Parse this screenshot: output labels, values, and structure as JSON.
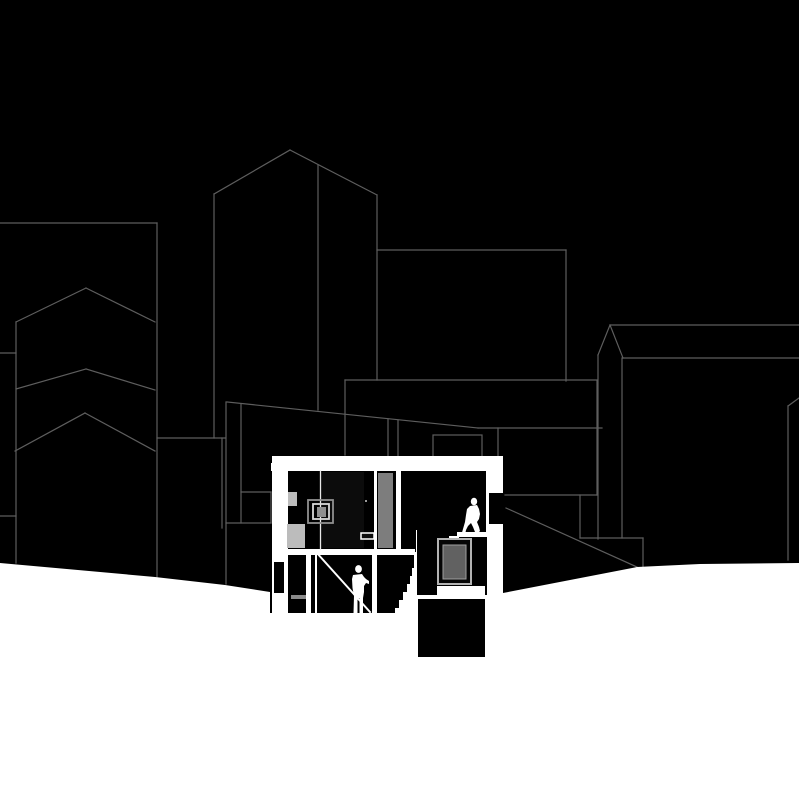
{
  "canvas": {
    "width": 799,
    "height": 800,
    "background": "#000000"
  },
  "palette": {
    "background": "#000000",
    "outline_gray": "#5e5e5e",
    "cut_white": "#ffffff",
    "light_gray_block": "#bcbcbc",
    "wardrobe_gray": "#7d7d7d",
    "pane_gray": "#616161",
    "frame_gray": "#b3b3b3",
    "door_panel_dark": "#0c0c0c",
    "step_gray": "#8a8a8a"
  },
  "layers": [
    {
      "name": "left-building-top-edge",
      "type": "line",
      "x1": 0,
      "y1": 223,
      "x2": 157,
      "y2": 223,
      "stroke": "#5e5e5e",
      "sw": 1.2
    },
    {
      "name": "left-building-right-edge",
      "type": "line",
      "x1": 157,
      "y1": 223,
      "x2": 157,
      "y2": 577,
      "stroke": "#5e5e5e",
      "sw": 1.2
    },
    {
      "name": "left-building-lower-edge",
      "type": "line",
      "x1": 157,
      "y1": 438,
      "x2": 225,
      "y2": 438,
      "stroke": "#5e5e5e",
      "sw": 1.2
    },
    {
      "name": "left-building-inner-vertical",
      "type": "line",
      "x1": 222,
      "y1": 438,
      "x2": 222,
      "y2": 528,
      "stroke": "#5e5e5e",
      "sw": 1.2
    },
    {
      "name": "gable-chevron-1-left",
      "type": "line",
      "x1": 16,
      "y1": 322,
      "x2": 86,
      "y2": 288,
      "stroke": "#5e5e5e",
      "sw": 1.2
    },
    {
      "name": "gable-chevron-1-right",
      "type": "line",
      "x1": 86,
      "y1": 288,
      "x2": 155,
      "y2": 322,
      "stroke": "#5e5e5e",
      "sw": 1.2
    },
    {
      "name": "gable-chevron-2-left",
      "type": "line",
      "x1": 16,
      "y1": 389,
      "x2": 86,
      "y2": 369,
      "stroke": "#5e5e5e",
      "sw": 1.2
    },
    {
      "name": "gable-chevron-2-right",
      "type": "line",
      "x1": 86,
      "y1": 369,
      "x2": 155,
      "y2": 390,
      "stroke": "#5e5e5e",
      "sw": 1.2
    },
    {
      "name": "gable-chevron-3-left",
      "type": "line",
      "x1": 15,
      "y1": 451,
      "x2": 85,
      "y2": 413,
      "stroke": "#5e5e5e",
      "sw": 1.2
    },
    {
      "name": "gable-chevron-3-right",
      "type": "line",
      "x1": 85,
      "y1": 413,
      "x2": 155,
      "y2": 451,
      "stroke": "#5e5e5e",
      "sw": 1.2
    },
    {
      "name": "gable-building-left-edge",
      "type": "line",
      "x1": 16,
      "y1": 322,
      "x2": 16,
      "y2": 563,
      "stroke": "#5e5e5e",
      "sw": 1.2
    },
    {
      "name": "left-edge-tick-upper",
      "type": "line",
      "x1": 0,
      "y1": 353,
      "x2": 16,
      "y2": 353,
      "stroke": "#5e5e5e",
      "sw": 1.2
    },
    {
      "name": "left-edge-tick-lower",
      "type": "line",
      "x1": 0,
      "y1": 516,
      "x2": 16,
      "y2": 516,
      "stroke": "#5e5e5e",
      "sw": 1.2
    },
    {
      "name": "tower-roof-left-slope",
      "type": "line",
      "x1": 214,
      "y1": 194,
      "x2": 290,
      "y2": 150,
      "stroke": "#5e5e5e",
      "sw": 1.2
    },
    {
      "name": "tower-roof-right-slope",
      "type": "line",
      "x1": 290,
      "y1": 150,
      "x2": 377,
      "y2": 195,
      "stroke": "#5e5e5e",
      "sw": 1.2
    },
    {
      "name": "tower-left-edge",
      "type": "line",
      "x1": 214,
      "y1": 194,
      "x2": 214,
      "y2": 438,
      "stroke": "#5e5e5e",
      "sw": 1.2
    },
    {
      "name": "tower-right-edge",
      "type": "line",
      "x1": 377,
      "y1": 195,
      "x2": 377,
      "y2": 380,
      "stroke": "#5e5e5e",
      "sw": 1.2
    },
    {
      "name": "tower-inner-vertical",
      "type": "line",
      "x1": 318,
      "y1": 165,
      "x2": 318,
      "y2": 410,
      "stroke": "#5e5e5e",
      "sw": 1.2
    },
    {
      "name": "midground-vertical-226",
      "type": "line",
      "x1": 226,
      "y1": 402,
      "x2": 226,
      "y2": 584,
      "stroke": "#5e5e5e",
      "sw": 1.2
    },
    {
      "name": "long-roof-slope",
      "type": "line",
      "x1": 227,
      "y1": 402,
      "x2": 478,
      "y2": 428,
      "stroke": "#5e5e5e",
      "sw": 1.2
    },
    {
      "name": "long-roof-flat",
      "type": "line",
      "x1": 478,
      "y1": 428,
      "x2": 602,
      "y2": 428,
      "stroke": "#5e5e5e",
      "sw": 1.2
    },
    {
      "name": "midground-vertical-241",
      "type": "line",
      "x1": 241,
      "y1": 404,
      "x2": 241,
      "y2": 523,
      "stroke": "#5e5e5e",
      "sw": 1.2
    },
    {
      "name": "midground-horizontal-492",
      "type": "line",
      "x1": 241,
      "y1": 492,
      "x2": 271,
      "y2": 492,
      "stroke": "#5e5e5e",
      "sw": 1.2
    },
    {
      "name": "midground-vertical-271",
      "type": "line",
      "x1": 271,
      "y1": 492,
      "x2": 271,
      "y2": 523,
      "stroke": "#5e5e5e",
      "sw": 1.2
    },
    {
      "name": "midground-horizontal-523",
      "type": "line",
      "x1": 226,
      "y1": 523,
      "x2": 271,
      "y2": 523,
      "stroke": "#5e5e5e",
      "sw": 1.2
    },
    {
      "name": "mid-block-top-edge",
      "type": "line",
      "x1": 377,
      "y1": 250,
      "x2": 566,
      "y2": 250,
      "stroke": "#5e5e5e",
      "sw": 1.2
    },
    {
      "name": "mid-block-right-edge",
      "type": "line",
      "x1": 566,
      "y1": 250,
      "x2": 566,
      "y2": 381,
      "stroke": "#5e5e5e",
      "sw": 1.2
    },
    {
      "name": "mid-block-bottom-edge",
      "type": "line",
      "x1": 345,
      "y1": 380,
      "x2": 597,
      "y2": 380,
      "stroke": "#5e5e5e",
      "sw": 1.2
    },
    {
      "name": "mid-block-left-drop",
      "type": "line",
      "x1": 345,
      "y1": 380,
      "x2": 345,
      "y2": 455,
      "stroke": "#5e5e5e",
      "sw": 1.2
    },
    {
      "name": "mid-block-right-drop",
      "type": "line",
      "x1": 597,
      "y1": 381,
      "x2": 597,
      "y2": 495,
      "stroke": "#5e5e5e",
      "sw": 1.2
    },
    {
      "name": "rear-terrace-edge",
      "type": "line",
      "x1": 505,
      "y1": 495,
      "x2": 597,
      "y2": 495,
      "stroke": "#5e5e5e",
      "sw": 1.2
    },
    {
      "name": "rear-step-vertical-580",
      "type": "line",
      "x1": 580,
      "y1": 495,
      "x2": 580,
      "y2": 538,
      "stroke": "#5e5e5e",
      "sw": 1.2
    },
    {
      "name": "rear-step-horizontal-538",
      "type": "line",
      "x1": 580,
      "y1": 538,
      "x2": 643,
      "y2": 538,
      "stroke": "#5e5e5e",
      "sw": 1.2
    },
    {
      "name": "rear-step-vertical-643",
      "type": "line",
      "x1": 643,
      "y1": 538,
      "x2": 643,
      "y2": 567,
      "stroke": "#5e5e5e",
      "sw": 1.2
    },
    {
      "name": "rear-ramp-diagonal",
      "type": "line",
      "x1": 506,
      "y1": 508,
      "x2": 637,
      "y2": 567,
      "stroke": "#5e5e5e",
      "sw": 1.2
    },
    {
      "name": "roof-drop-vertical-498",
      "type": "line",
      "x1": 498,
      "y1": 428,
      "x2": 498,
      "y2": 456,
      "stroke": "#5e5e5e",
      "sw": 1.2
    },
    {
      "name": "roof-drop-vertical-388",
      "type": "line",
      "x1": 388,
      "y1": 419,
      "x2": 388,
      "y2": 456,
      "stroke": "#5e5e5e",
      "sw": 1.2
    },
    {
      "name": "roof-drop-vertical-398",
      "type": "line",
      "x1": 398,
      "y1": 420,
      "x2": 398,
      "y2": 456,
      "stroke": "#5e5e5e",
      "sw": 1.2
    },
    {
      "name": "chimney-outline",
      "type": "rect",
      "x": 433,
      "y": 435,
      "w": 49,
      "h": 23,
      "fill": "#000000",
      "stroke": "#5e5e5e",
      "sw": 1.2
    },
    {
      "name": "spire-left-slope",
      "type": "line",
      "x1": 598,
      "y1": 355,
      "x2": 610,
      "y2": 325,
      "stroke": "#5e5e5e",
      "sw": 1.2
    },
    {
      "name": "spire-right-slope",
      "type": "line",
      "x1": 610,
      "y1": 325,
      "x2": 623,
      "y2": 358,
      "stroke": "#5e5e5e",
      "sw": 1.2
    },
    {
      "name": "spire-left-edge",
      "type": "line",
      "x1": 598,
      "y1": 355,
      "x2": 598,
      "y2": 539,
      "stroke": "#5e5e5e",
      "sw": 1.2
    },
    {
      "name": "spire-right-edge",
      "type": "line",
      "x1": 622,
      "y1": 358,
      "x2": 622,
      "y2": 538,
      "stroke": "#5e5e5e",
      "sw": 1.2
    },
    {
      "name": "right-building-parapet",
      "type": "line",
      "x1": 610,
      "y1": 325,
      "x2": 799,
      "y2": 325,
      "stroke": "#5e5e5e",
      "sw": 1.2
    },
    {
      "name": "right-building-roofline",
      "type": "line",
      "x1": 623,
      "y1": 358,
      "x2": 799,
      "y2": 358,
      "stroke": "#5e5e5e",
      "sw": 1.2
    },
    {
      "name": "far-right-vertical",
      "type": "line",
      "x1": 788,
      "y1": 406,
      "x2": 788,
      "y2": 560,
      "stroke": "#5e5e5e",
      "sw": 1.2
    },
    {
      "name": "far-right-diagonal",
      "type": "line",
      "x1": 788,
      "y1": 406,
      "x2": 799,
      "y2": 398,
      "stroke": "#5e5e5e",
      "sw": 1.2
    },
    {
      "name": "ground-plane",
      "type": "polygon",
      "points": "0,563 155,577 225,585 270,592 270,613 414,613 414,595 489,595 489,593 503,593 637,567 700,564 799,563 799,800 0,800",
      "fill": "#ffffff"
    },
    {
      "name": "section-roof-band",
      "type": "rect",
      "x": 271,
      "y": 456,
      "w": 232,
      "h": 15,
      "fill": "#ffffff"
    },
    {
      "name": "section-roof-corner-notch",
      "type": "rect",
      "x": 271,
      "y": 456,
      "w": 12,
      "h": 7,
      "fill": "#000000"
    },
    {
      "name": "section-left-wall",
      "type": "rect",
      "x": 272,
      "y": 456,
      "w": 18,
      "h": 157,
      "fill": "#ffffff"
    },
    {
      "name": "left-wall-window-opening",
      "type": "rect",
      "x": 274,
      "y": 562,
      "w": 10,
      "h": 31,
      "fill": "#000000"
    },
    {
      "name": "section-right-wall",
      "type": "rect",
      "x": 486,
      "y": 456,
      "w": 17,
      "h": 139,
      "fill": "#ffffff"
    },
    {
      "name": "right-wall-window-opening",
      "type": "rect",
      "x": 489,
      "y": 493,
      "w": 14,
      "h": 31,
      "fill": "#000000"
    },
    {
      "name": "upper-rooms-interior",
      "type": "rect",
      "x": 288,
      "y": 471,
      "w": 198,
      "h": 78,
      "fill": "#000000"
    },
    {
      "name": "lower-room-interior",
      "type": "rect",
      "x": 288,
      "y": 549,
      "w": 129,
      "h": 64,
      "fill": "#000000"
    },
    {
      "name": "mid-floor-slab",
      "type": "rect",
      "x": 288,
      "y": 549,
      "w": 129,
      "h": 6,
      "fill": "#ffffff"
    },
    {
      "name": "window-room-interior",
      "type": "rect",
      "x": 415,
      "y": 537,
      "w": 72,
      "h": 58,
      "fill": "#000000"
    },
    {
      "name": "right-light-well",
      "type": "rect",
      "x": 487,
      "y": 537,
      "w": 16,
      "h": 58,
      "fill": "#ffffff"
    },
    {
      "name": "upper-right-floor-slab",
      "type": "rect",
      "x": 457,
      "y": 532,
      "w": 46,
      "h": 5,
      "fill": "#ffffff"
    },
    {
      "name": "entry-step-1",
      "type": "rect",
      "x": 449,
      "y": 536,
      "w": 10,
      "h": 5,
      "fill": "#ffffff"
    },
    {
      "name": "entry-step-2",
      "type": "rect",
      "x": 443,
      "y": 540,
      "w": 10,
      "h": 5,
      "fill": "#ffffff"
    },
    {
      "name": "entry-step-3",
      "type": "rect",
      "x": 437,
      "y": 544,
      "w": 10,
      "h": 5,
      "fill": "#ffffff"
    },
    {
      "name": "main-staircase",
      "type": "polygon",
      "points": "417,530 417,613 395,613 395,608 399,608 399,600 403,600 403,592 407,592 407,584 410,584 410,576 412,576 412,568 414,568 414,552 416,552 416,530",
      "fill": "#ffffff"
    },
    {
      "name": "basement-slit",
      "type": "rect",
      "x": 437,
      "y": 586,
      "w": 48,
      "h": 9,
      "fill": "#ffffff"
    },
    {
      "name": "basement-block",
      "type": "rect",
      "x": 418,
      "y": 599,
      "w": 67,
      "h": 58,
      "fill": "#000000"
    },
    {
      "name": "stair-room-stud-1",
      "type": "rect",
      "x": 306,
      "y": 555,
      "w": 5,
      "h": 58,
      "fill": "#ffffff"
    },
    {
      "name": "stair-room-stud-2",
      "type": "rect",
      "x": 315,
      "y": 555,
      "w": 2,
      "h": 58,
      "fill": "#ffffff"
    },
    {
      "name": "stair-room-stud-3",
      "type": "rect",
      "x": 372,
      "y": 555,
      "w": 5,
      "h": 58,
      "fill": "#ffffff"
    },
    {
      "name": "stair-room-step-gray",
      "type": "rect",
      "x": 291,
      "y": 595,
      "w": 15,
      "h": 4,
      "fill": "#8a8a8a"
    },
    {
      "name": "stair-stringer-diagonal",
      "type": "line",
      "x1": 316,
      "y1": 552,
      "x2": 370,
      "y2": 612,
      "stroke": "#ffffff",
      "sw": 2
    },
    {
      "name": "door-panel",
      "type": "rect",
      "x": 321,
      "y": 472,
      "w": 43,
      "h": 76,
      "fill": "#0c0c0c"
    },
    {
      "name": "room-divider-line",
      "type": "line",
      "x1": 320.5,
      "y1": 471,
      "x2": 320.5,
      "y2": 549,
      "stroke": "#e8e8e8",
      "sw": 1.3
    },
    {
      "name": "wall-block-upper",
      "type": "rect",
      "x": 288,
      "y": 492,
      "w": 9,
      "h": 14,
      "fill": "#bcbcbc"
    },
    {
      "name": "wall-block-lower",
      "type": "rect",
      "x": 287,
      "y": 524,
      "w": 18,
      "h": 24,
      "fill": "#bcbcbc"
    },
    {
      "name": "wall-art-square-outer",
      "type": "rect",
      "x": 308,
      "y": 500,
      "w": 25,
      "h": 23,
      "fill": "none",
      "stroke": "#909090",
      "sw": 1.8
    },
    {
      "name": "wall-art-square-mid",
      "type": "rect",
      "x": 313,
      "y": 504,
      "w": 16,
      "h": 15,
      "fill": "none",
      "stroke": "#d8d8d8",
      "sw": 1.8
    },
    {
      "name": "wall-art-square-center",
      "type": "rect",
      "x": 317,
      "y": 507,
      "w": 9,
      "h": 10,
      "fill": "#8f8f8f"
    },
    {
      "name": "door-handle-dot",
      "type": "rect",
      "x": 365,
      "y": 500,
      "w": 2,
      "h": 2,
      "fill": "#9a9a9a"
    },
    {
      "name": "shelf-outline",
      "type": "rect",
      "x": 361,
      "y": 533,
      "w": 13,
      "h": 6,
      "fill": "#0c0c0c",
      "stroke": "#ffffff",
      "sw": 1.5
    },
    {
      "name": "wardrobe-gap-left",
      "type": "rect",
      "x": 374,
      "y": 471,
      "w": 3,
      "h": 78,
      "fill": "#ffffff"
    },
    {
      "name": "wardrobe-panel",
      "type": "rect",
      "x": 378,
      "y": 473,
      "w": 15,
      "h": 75,
      "fill": "#7d7d7d"
    },
    {
      "name": "wardrobe-gap-right",
      "type": "rect",
      "x": 396,
      "y": 471,
      "w": 5,
      "h": 78,
      "fill": "#ffffff"
    },
    {
      "name": "lightwell-window-frame",
      "type": "rect",
      "x": 438,
      "y": 539,
      "w": 33,
      "h": 45,
      "fill": "#050505",
      "stroke": "#b3b3b3",
      "sw": 2
    },
    {
      "name": "lightwell-window-pane",
      "type": "rect",
      "x": 443,
      "y": 545,
      "w": 23,
      "h": 34,
      "fill": "#616161",
      "stroke": "#9e9e9e",
      "sw": 1
    },
    {
      "name": "figure-standing-head",
      "type": "ellipse",
      "cx": 358.5,
      "cy": 569,
      "rx": 3.4,
      "ry": 3.9,
      "fill": "#ffffff"
    },
    {
      "name": "figure-standing-body",
      "type": "polygon",
      "points": "353,575 362,574 364,577 366,579 369,581 369,584 366,583 364,586 364,592 363,598 363,613 359.5,614 359.5,598 357.5,598 357.5,614 353.5,613 354,596 352.5,588 352,579",
      "fill": "#ffffff"
    },
    {
      "name": "figure-walking-head",
      "type": "ellipse",
      "cx": 474,
      "cy": 501.5,
      "rx": 3.2,
      "ry": 3.8,
      "fill": "#ffffff"
    },
    {
      "name": "figure-walking-body",
      "type": "polygon",
      "points": "470,506 477,505 479,509 480,514 479,519 477,522 479,527 480,531 479,532 475,532 473,527 471,523 468,526 466,530 465,535 461,536 463,529 465,522 466,515 467,509",
      "fill": "#ffffff"
    }
  ]
}
